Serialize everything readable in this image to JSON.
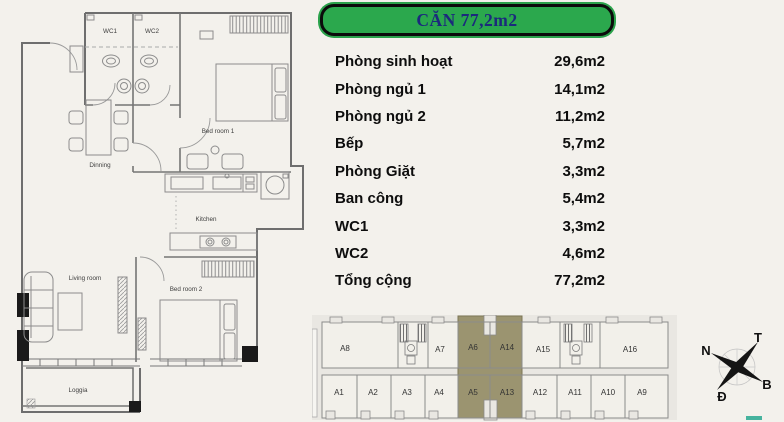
{
  "header": {
    "title": "CĂN 77,2m2"
  },
  "colors": {
    "header_green": "#2ba84d",
    "title_navy": "#1b2a7c",
    "unit_highlight": "#9b9470",
    "teal_mark": "#46b39e"
  },
  "area_table": {
    "rows": [
      {
        "label": "Phòng sinh hoạt",
        "value": "29,6m2"
      },
      {
        "label": "Phòng ngủ 1",
        "value": "14,1m2"
      },
      {
        "label": "Phòng ngủ 2",
        "value": "11,2m2"
      },
      {
        "label": "Bếp",
        "value": "5,7m2"
      },
      {
        "label": "Phòng Giặt",
        "value": "3,3m2"
      },
      {
        "label": "Ban công",
        "value": "5,4m2"
      },
      {
        "label": "WC1",
        "value": "3,3m2"
      },
      {
        "label": "WC2",
        "value": "4,6m2"
      },
      {
        "label": "Tổng cộng",
        "value": "77,2m2"
      }
    ]
  },
  "floor_plan": {
    "labels": {
      "wc1": "WC1",
      "wc2": "WC2",
      "bedroom1": "Bed room 1",
      "dinning": "Dinning",
      "kitchen": "Kitchen",
      "living_room": "Living room",
      "bedroom2": "Bed room 2",
      "loggia": "Loggia"
    }
  },
  "site_plan": {
    "highlighted_units": [
      "A6",
      "A14",
      "A5",
      "A13"
    ],
    "top_units": [
      {
        "label": "A8"
      },
      {
        "label": "A7"
      },
      {
        "label": "A6"
      },
      {
        "label": "A14"
      },
      {
        "label": "A15"
      },
      {
        "label": "A16"
      }
    ],
    "bottom_units": [
      {
        "label": "A1"
      },
      {
        "label": "A2"
      },
      {
        "label": "A3"
      },
      {
        "label": "A4"
      },
      {
        "label": "A5"
      },
      {
        "label": "A13"
      },
      {
        "label": "A12"
      },
      {
        "label": "A11"
      },
      {
        "label": "A10"
      },
      {
        "label": "A9"
      }
    ]
  },
  "compass": {
    "top_left": "N",
    "top_right": "T",
    "bottom_right": "B",
    "bottom_left": "Đ"
  }
}
